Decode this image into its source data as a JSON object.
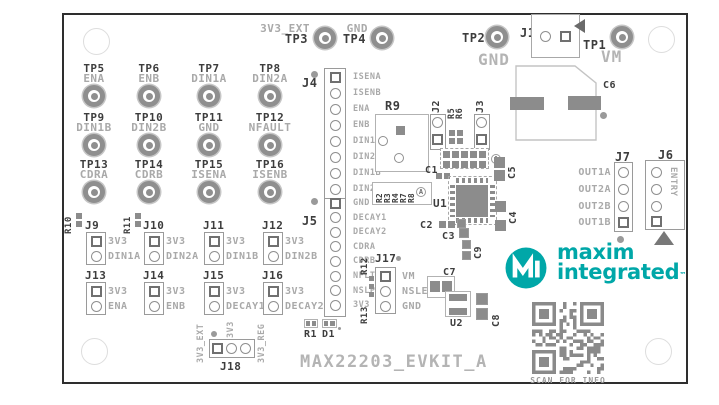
{
  "title": "MAX22203_EVKIT_A",
  "colors": {
    "teal": "#00a7a8",
    "silk_dark": "#3d3d3d",
    "silk_light": "#a9a9a9",
    "pad": "#8c8c8c",
    "qr": "#8a8a8a"
  },
  "logo": {
    "word1": "maxim",
    "word2": "integrated",
    "tm": "™"
  },
  "qr": {
    "caption": "SCAN FOR INFO"
  },
  "top_tps": {
    "tp3": {
      "ref": "TP3",
      "net": "3V3_EXT"
    },
    "tp4": {
      "ref": "TP4",
      "net": "GND"
    },
    "tp2": {
      "ref": "TP2",
      "net": "GND"
    },
    "tp1": {
      "ref": "TP1",
      "net": "VM"
    }
  },
  "tp_grid": [
    {
      "ref": "TP5",
      "net": "ENA"
    },
    {
      "ref": "TP6",
      "net": "ENB"
    },
    {
      "ref": "TP7",
      "net": "DIN1A"
    },
    {
      "ref": "TP8",
      "net": "DIN2A"
    },
    {
      "ref": "TP9",
      "net": "DIN1B"
    },
    {
      "ref": "TP10",
      "net": "DIN2B"
    },
    {
      "ref": "TP11",
      "net": "GND"
    },
    {
      "ref": "TP12",
      "net": "NFAULT"
    },
    {
      "ref": "TP13",
      "net": "CDRA"
    },
    {
      "ref": "TP14",
      "net": "CDRB"
    },
    {
      "ref": "TP15",
      "net": "ISENA"
    },
    {
      "ref": "TP16",
      "net": "ISENB"
    }
  ],
  "j1": {
    "ref": "J1"
  },
  "c6": {
    "ref": "C6"
  },
  "j4": {
    "ref": "J4",
    "pins": [
      "ISENA",
      "ISENB",
      "ENA",
      "ENB",
      "DIN1A",
      "DIN2A",
      "DIN1B",
      "DIN2B"
    ]
  },
  "j5": {
    "ref": "J5",
    "pins": [
      "GND",
      "DECAY1",
      "DECAY2",
      "CDRA",
      "CDRB",
      "NFLT",
      "NSLP",
      "3V3"
    ]
  },
  "j2": {
    "ref": "J2"
  },
  "j3": {
    "ref": "J3"
  },
  "r9": {
    "ref": "R9"
  },
  "r5": "R5",
  "r6": "R6",
  "rbank": {
    "labels": [
      "R2",
      "R3",
      "R4",
      "R7",
      "R8"
    ],
    "marker": "A"
  },
  "header2x5": {
    "marker": "A"
  },
  "u1": "U1",
  "u2": "U2",
  "c1": "C1",
  "c2": "C2",
  "c3": "C3",
  "c4": "C4",
  "c5": "C5",
  "c7": "C7",
  "c8": "C8",
  "c9": "C9",
  "j17": {
    "ref": "J17",
    "pins": [
      "VM",
      "NSLEEP",
      "GND"
    ]
  },
  "r10": "R10",
  "r11": "R11",
  "r12": "R12",
  "r13": "R13",
  "r1": "R1",
  "d1": "D1",
  "jumpers": [
    {
      "ref": "J9",
      "top": "3V3",
      "bottom": "DIN1A"
    },
    {
      "ref": "J10",
      "top": "3V3",
      "bottom": "DIN2A"
    },
    {
      "ref": "J11",
      "top": "3V3",
      "bottom": "DIN1B"
    },
    {
      "ref": "J12",
      "top": "3V3",
      "bottom": "DIN2B"
    },
    {
      "ref": "J13",
      "top": "3V3",
      "bottom": "ENA"
    },
    {
      "ref": "J14",
      "top": "3V3",
      "bottom": "ENB"
    },
    {
      "ref": "J15",
      "top": "3V3",
      "bottom": "DECAY1"
    },
    {
      "ref": "J16",
      "top": "3V3",
      "bottom": "DECAY2"
    }
  ],
  "j18": {
    "ref": "J18",
    "nets": [
      "3V3_EXT",
      "3V3",
      "3V3_REG"
    ]
  },
  "j7": {
    "ref": "J7",
    "pins": [
      "OUT1A",
      "OUT2A",
      "OUT2B",
      "OUT1B"
    ]
  },
  "j6": {
    "ref": "J6",
    "marking": "ENTRY"
  }
}
